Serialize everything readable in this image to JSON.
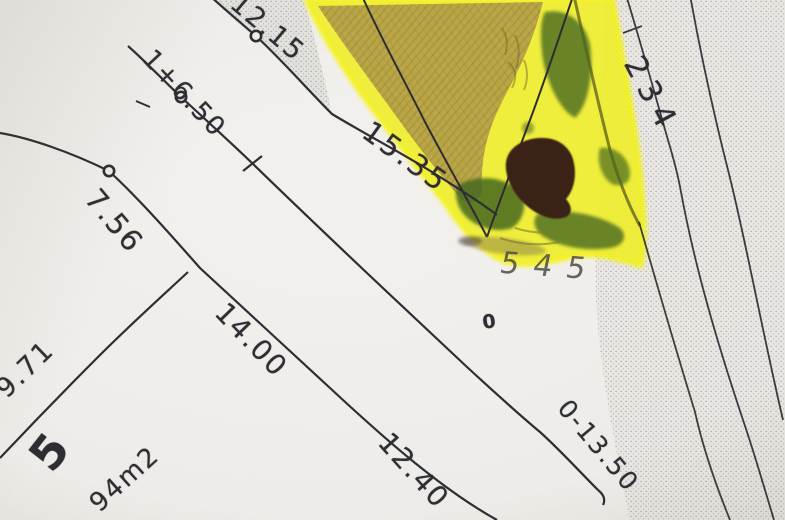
{
  "plan": {
    "dimensions": {
      "top_boundary": "12.15",
      "upper_line": "1+6.50",
      "left_segment": "7.56",
      "highlight_edge": "15.35",
      "middle_line": "14.00",
      "lower_segment": "12.40",
      "bottom_right": "0-13.50",
      "left_lower": "9.71"
    },
    "parcel": {
      "number": "5",
      "area": "94m2"
    },
    "annotations": {
      "road_label": "234",
      "pencil_note": "545",
      "zero_mark": "0"
    },
    "colors": {
      "paper": "#efede9",
      "ink": "#2e2d33",
      "highlighter_yellow": "#f0ee27",
      "highlighter_edge": "#f6f400",
      "olive_shading": "#b4a049",
      "marker_green": "#47691f",
      "hole_brown": "#3a2115",
      "pencil_gray": "#4f4b49",
      "stipple_gray": "#8d8d8b"
    }
  }
}
